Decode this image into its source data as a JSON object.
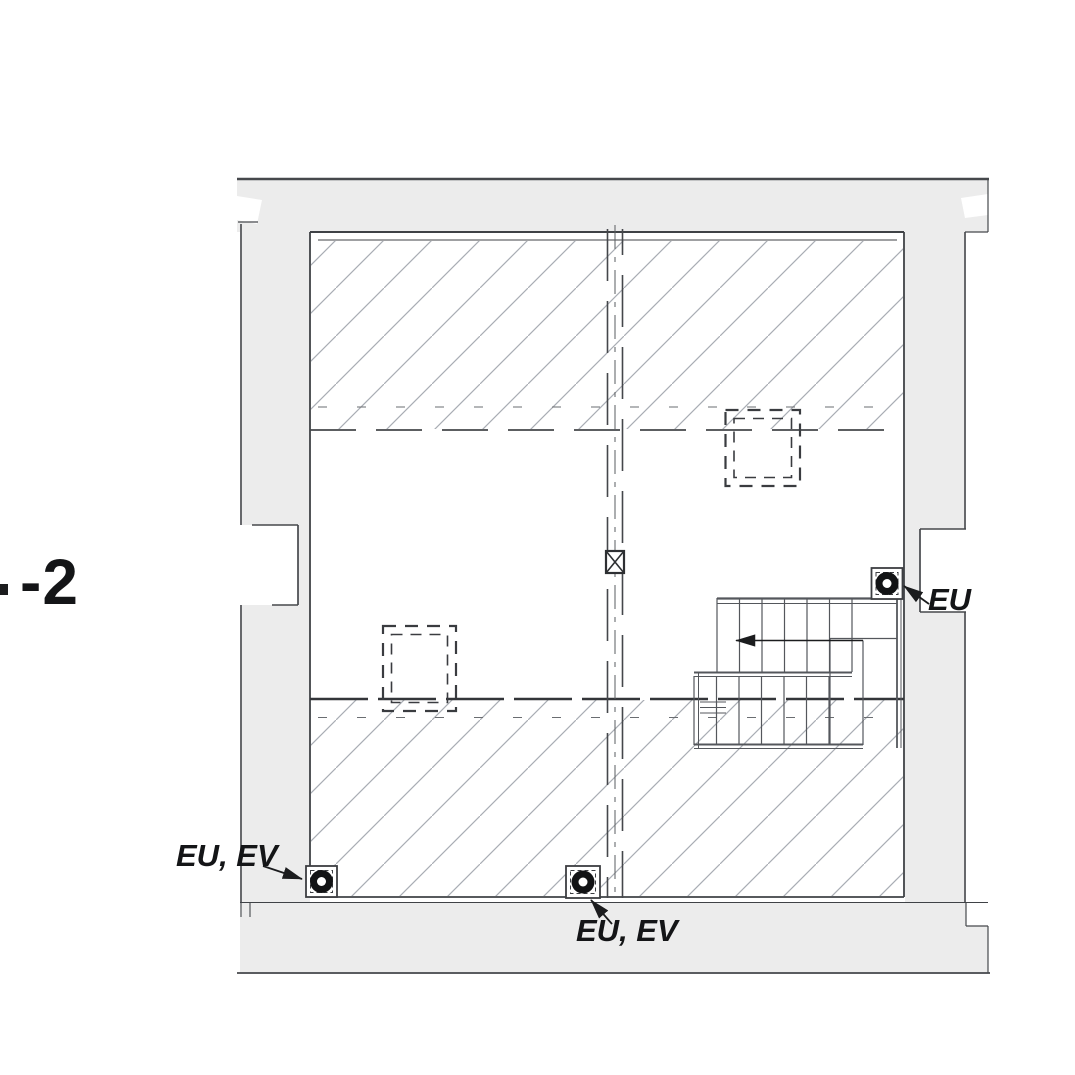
{
  "plan": {
    "type": "architectural-floor-plan-scan",
    "level_label": "-2",
    "drains": [
      {
        "id": "top-right",
        "label": "EU",
        "symbol": "floor-drain-icon"
      },
      {
        "id": "bottom-left",
        "label": "EU, EV",
        "symbol": "floor-drain-icon"
      },
      {
        "id": "bottom-center",
        "label": "EU, EV",
        "symbol": "floor-drain-icon"
      }
    ],
    "stair": {
      "direction_arrow": "left"
    },
    "symbols": {
      "shaft": "x-box-shaft-symbol",
      "columns": "dashed-square-column-outline",
      "section_hatch": "diagonal-hatch"
    },
    "colors": {
      "wall_fill": "#ececec",
      "outline_dark": "#3f4246",
      "outline_medium": "#55585c",
      "hatch_line": "#a9adb4",
      "text": "#141517"
    }
  }
}
